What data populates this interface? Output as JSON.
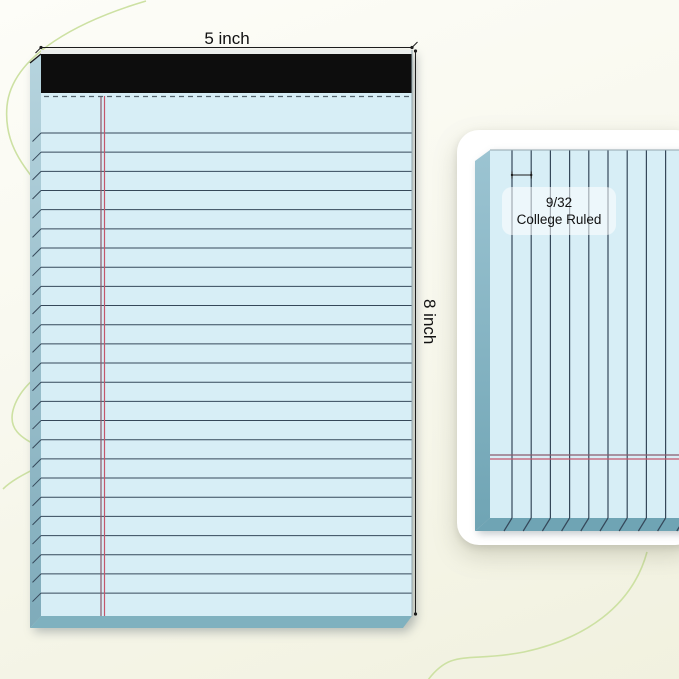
{
  "product_view": {
    "width_label": "5 inch",
    "height_label": "8 inch",
    "detail_label_line1": "9/32",
    "detail_label_line2": "College Ruled"
  },
  "colors": {
    "background_top": "#fdfdf8",
    "background_mid": "#f8f8ee",
    "background_bottom": "#f1f1df",
    "squiggle": "#cde1a3",
    "paper": "#d7eef6",
    "side_top": "#b6d4de",
    "side_bottom": "#7fabba",
    "bottom_edge": "#7fb1bf",
    "card_edge": "#6fa4b4",
    "card_edge_light": "#9cc4d2",
    "binding": "#0d0d0d",
    "top_edge": "#e9eceb",
    "rule_line": "#35485a",
    "margin_dark": "#8a5a6c",
    "margin_red": "#c5566b",
    "perforation": "#54656e",
    "dimension": "#1c1c1c",
    "text": "#111111",
    "card_bg": "#ffffff",
    "label_bg": "rgba(255,255,255,0.55)"
  },
  "ruling": {
    "front": {
      "line_count": 25,
      "first": 133,
      "step": 19.17,
      "x1": 41,
      "x2": 412,
      "tick_dx": -8.5,
      "tick_dy": 8.5
    },
    "detail": {
      "line_count": 11,
      "first": 55,
      "step": 19.2,
      "y1": 20,
      "y2": 388,
      "tick_dx": -8,
      "tick_dy": 13
    }
  }
}
